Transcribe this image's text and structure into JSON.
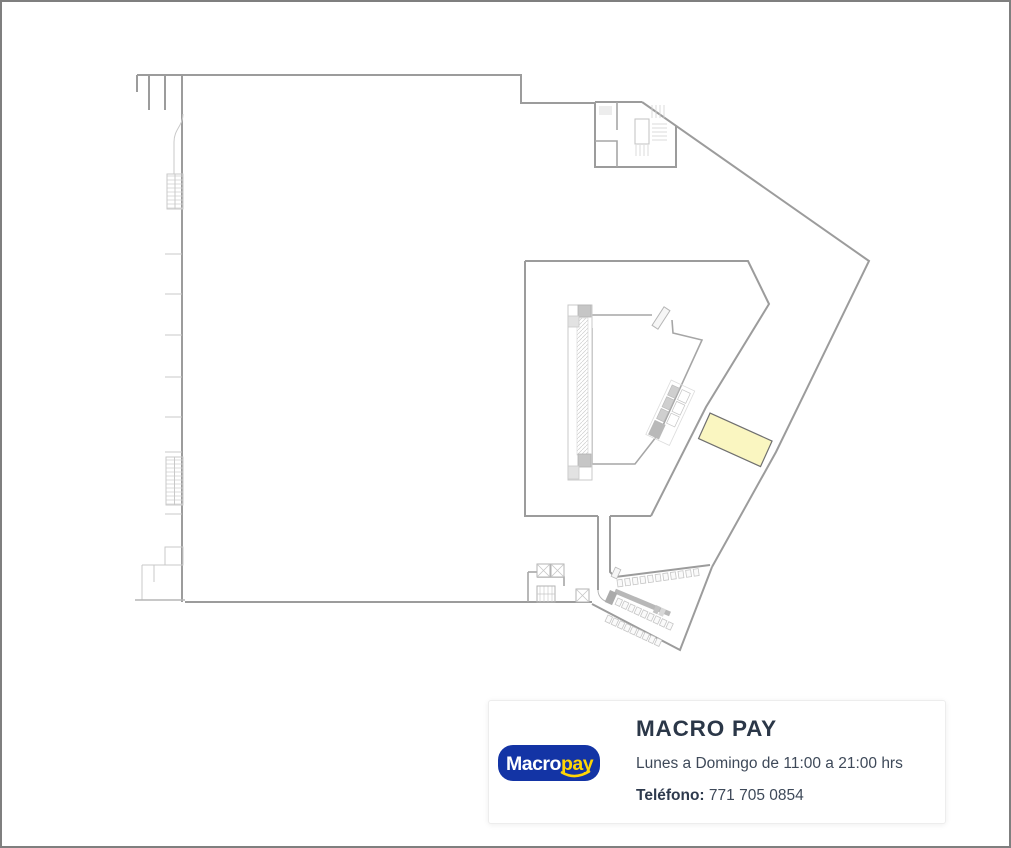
{
  "window": {
    "background": "#ffffff",
    "frame_border_color": "#7f7f7f"
  },
  "floor_plan": {
    "wall_color": "#9c9c9c",
    "highlight": {
      "fill": "#faf6c1",
      "stroke": "#6f6f6f"
    }
  },
  "info_card": {
    "title": "MACRO PAY",
    "schedule": "Lunes a Domingo de 11:00 a 21:00 hrs",
    "phone_label": "Teléfono:",
    "phone_value": "771 705 0854",
    "logo": {
      "text_primary": "Macro",
      "text_secondary": "pay",
      "background": "#1334a5",
      "primary_color": "#ffffff",
      "accent_color": "#ffd504"
    }
  }
}
